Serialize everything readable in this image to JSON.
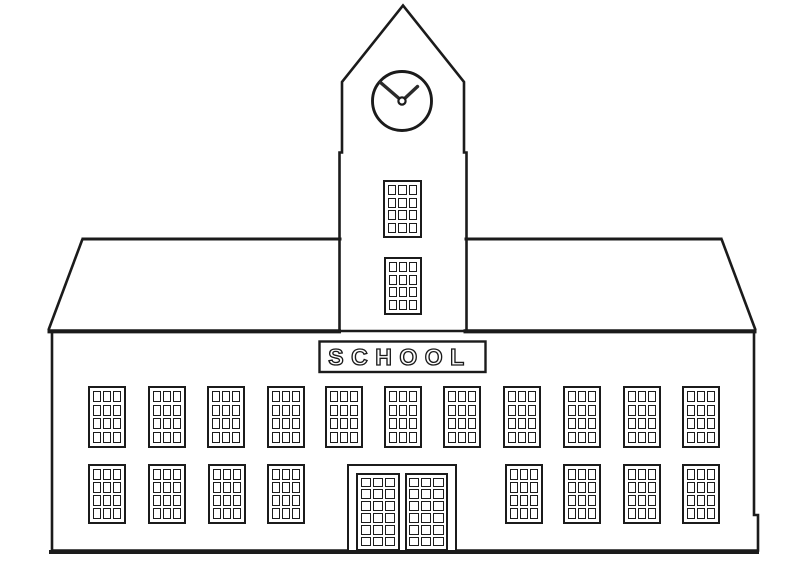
{
  "scene": {
    "subject": "school building line drawing with clock tower (coloring page)",
    "background_color": "#ffffff",
    "line_color": "#1b1b1b"
  },
  "sign": {
    "text": "SCHOOL"
  },
  "clock": {
    "cx": 402,
    "cy": 101,
    "radius": 29.5,
    "center_dot_radius": 3.6,
    "minute_hand": {
      "x2": 380.5,
      "y2": 82.5
    },
    "hour_hand": {
      "x2": 417.5,
      "y2": 86.5
    }
  },
  "windows": {
    "rows": [
      {
        "name": "upper-row",
        "y": 386,
        "width": 38,
        "height": 62,
        "pane_cols": 3,
        "pane_rows": 4,
        "x_positions": [
          88,
          148,
          207,
          267,
          325,
          384,
          443,
          503,
          563,
          623,
          682
        ]
      },
      {
        "name": "lower-row",
        "y": 464,
        "width": 38,
        "height": 60,
        "pane_cols": 3,
        "pane_rows": 4,
        "x_positions": [
          88,
          148,
          208,
          267,
          505,
          563,
          623,
          682
        ]
      },
      {
        "name": "tower-upper",
        "y": 180,
        "width": 39,
        "height": 58,
        "pane_cols": 3,
        "pane_rows": 4,
        "x_positions": [
          383
        ]
      },
      {
        "name": "tower-lower",
        "y": 257,
        "width": 38,
        "height": 58,
        "pane_cols": 3,
        "pane_rows": 4,
        "x_positions": [
          384
        ]
      }
    ]
  },
  "door": {
    "x": 347,
    "y": 464,
    "width": 110,
    "height": 87,
    "leaf_count": 2,
    "pane_cols": 3,
    "pane_rows": 6
  }
}
